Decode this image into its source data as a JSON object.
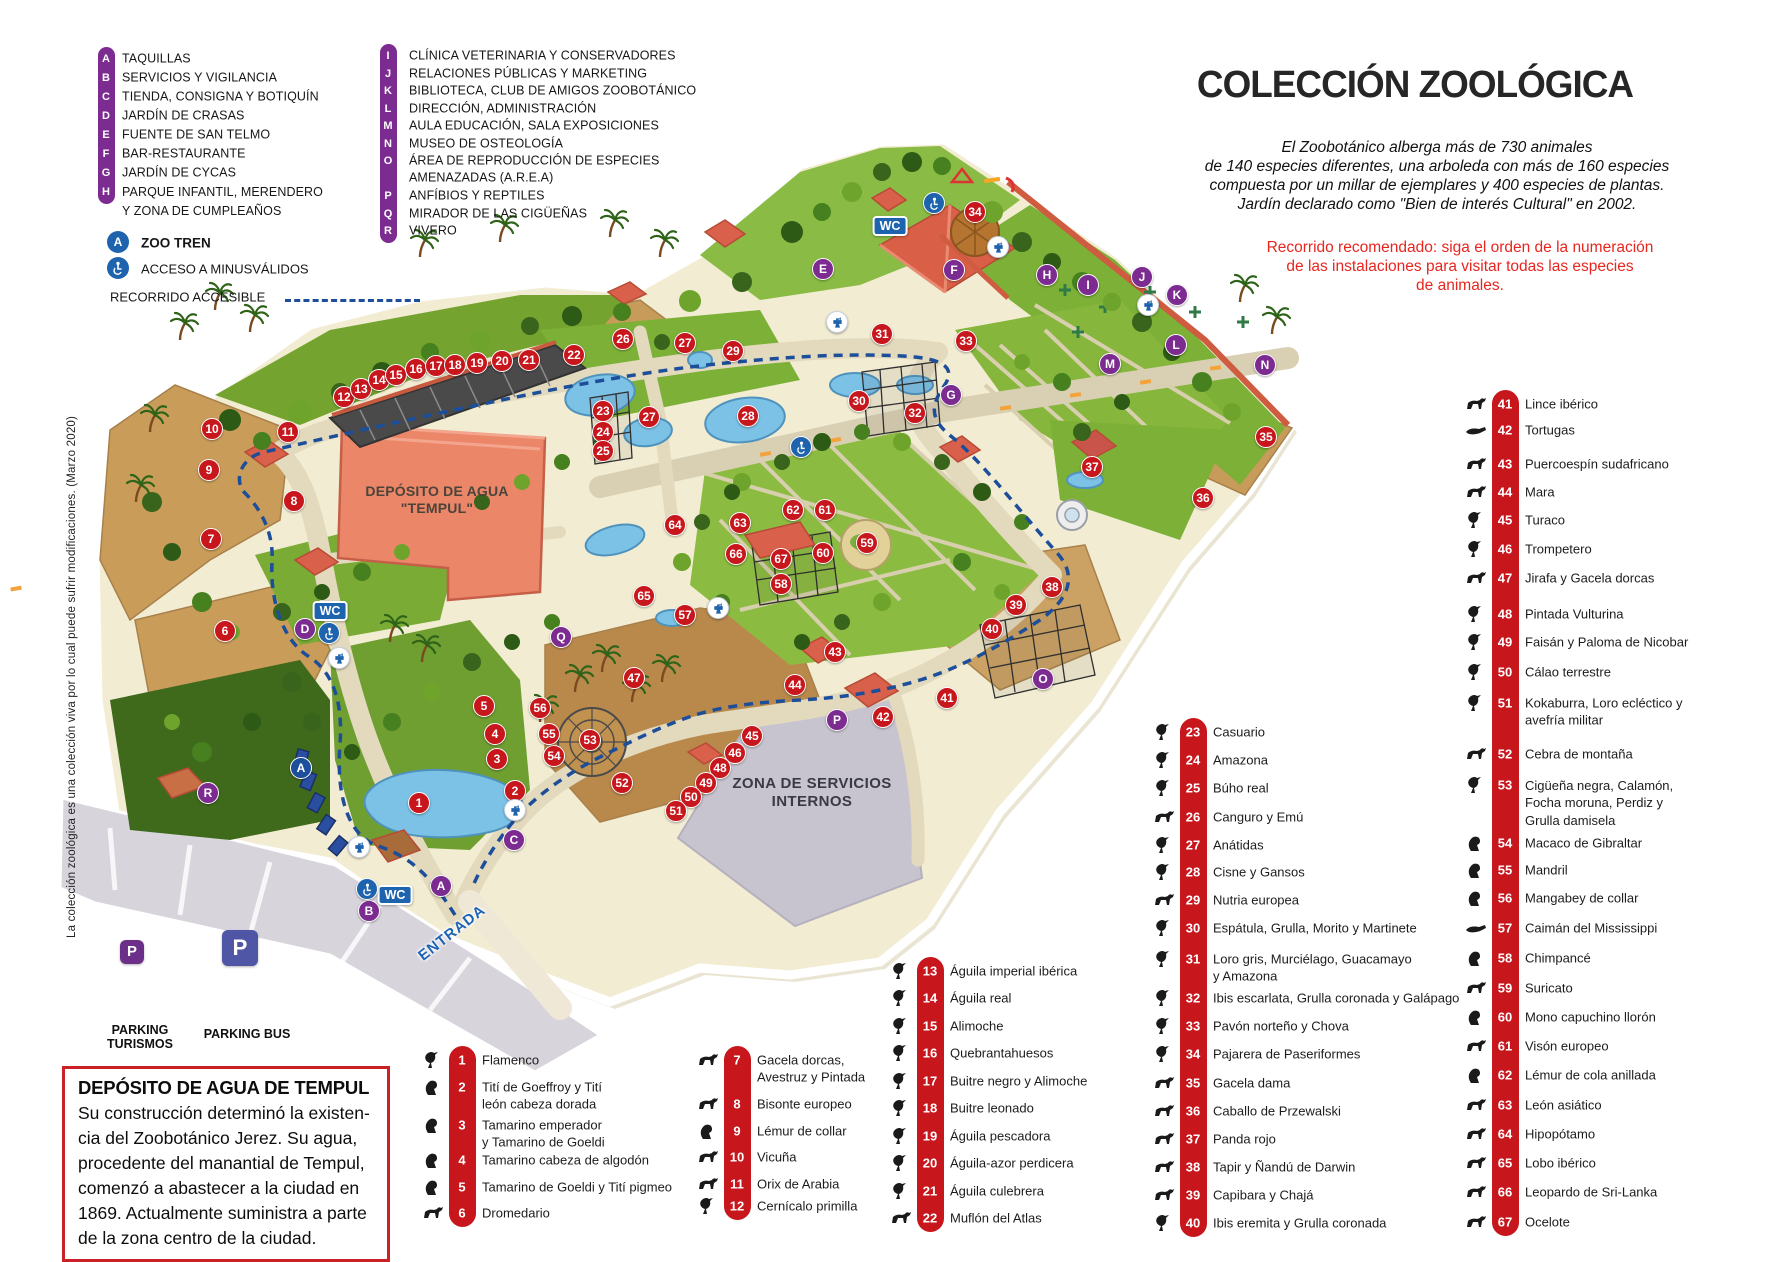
{
  "colors": {
    "red": "#c8161d",
    "purple": "#7c2b90",
    "blue": "#1e63ae",
    "route_blue": "#1d4e9a",
    "note_red": "#e8251f"
  },
  "legend": {
    "col1": [
      {
        "letter": "A",
        "label": "TAQUILLAS"
      },
      {
        "letter": "B",
        "label": "SERVICIOS Y VIGILANCIA"
      },
      {
        "letter": "C",
        "label": "TIENDA, CONSIGNA Y BOTIQUÍN"
      },
      {
        "letter": "D",
        "label": "JARDÍN DE CRASAS"
      },
      {
        "letter": "E",
        "label": "FUENTE DE SAN TELMO"
      },
      {
        "letter": "F",
        "label": "BAR-RESTAURANTE"
      },
      {
        "letter": "G",
        "label": "JARDÍN DE CYCAS"
      },
      {
        "letter": "H",
        "label": "PARQUE INFANTIL, MERENDERO\nY ZONA DE CUMPLEAÑOS"
      }
    ],
    "col2": [
      {
        "letter": "I",
        "label": "CLÍNICA VETERINARIA Y CONSERVADORES"
      },
      {
        "letter": "J",
        "label": "RELACIONES PÚBLICAS Y MARKETING"
      },
      {
        "letter": "K",
        "label": "BIBLIOTECA, CLUB DE AMIGOS ZOOBOTÁNICO"
      },
      {
        "letter": "L",
        "label": "DIRECCIÓN, ADMINISTRACIÓN"
      },
      {
        "letter": "M",
        "label": "AULA EDUCACIÓN, SALA EXPOSICIONES"
      },
      {
        "letter": "N",
        "label": "MUSEO DE OSTEOLOGÍA"
      },
      {
        "letter": "O",
        "label": "ÁREA DE REPRODUCCIÓN DE ESPECIES\nAMENAZADAS (A.R.E.A)"
      },
      {
        "letter": "P",
        "label": "ANFÍBIOS Y REPTILES"
      },
      {
        "letter": "Q",
        "label": "MIRADOR DE LAS CIGÜEÑAS"
      },
      {
        "letter": "R",
        "label": "VIVERO"
      }
    ],
    "zoo_tren_letter": "A",
    "zoo_tren": "ZOO TREN",
    "acceso": "ACCESO A MINUSVÁLIDOS",
    "recorrido": "RECORRIDO ACCESIBLE"
  },
  "header": {
    "title": "COLECCIÓN ZOOLÓGICA",
    "intro_lines": [
      "El Zoobotánico alberga más de 730 animales",
      "de 140 especies diferentes,  una arboleda con más de 160 especies",
      "compuesta por un millar de  ejemplares y 400 especies de plantas.",
      "Jardín declarado como \"Bien de interés Cultural\" en 2002."
    ],
    "route_lines": [
      "Recorrido recomendado: siga el orden de la numeración",
      "de las instalaciones para visitar todas las especies",
      "de animales."
    ]
  },
  "species_columns": [
    {
      "bar_x": 462,
      "items": [
        {
          "n": "1",
          "y": 1060,
          "icon": "bird",
          "label": "Flamenco"
        },
        {
          "n": "2",
          "y": 1087,
          "icon": "primate",
          "label": "Tití de Goeffroy y Tití\nleón cabeza dorada"
        },
        {
          "n": "3",
          "y": 1125,
          "icon": "primate",
          "label": "Tamarino emperador\ny Tamarino de Goeldi"
        },
        {
          "n": "4",
          "y": 1160,
          "icon": "primate",
          "label": "Tamarino cabeza de algodón"
        },
        {
          "n": "5",
          "y": 1187,
          "icon": "primate",
          "label": "Tamarino de Goeldi y Tití pigmeo"
        },
        {
          "n": "6",
          "y": 1213,
          "icon": "mammal",
          "label": "Dromedario"
        }
      ]
    },
    {
      "bar_x": 737,
      "items": [
        {
          "n": "7",
          "y": 1060,
          "icon": "mammal",
          "label": "Gacela dorcas,\nAvestruz y Pintada"
        },
        {
          "n": "8",
          "y": 1104,
          "icon": "mammal",
          "label": "Bisonte europeo"
        },
        {
          "n": "9",
          "y": 1131,
          "icon": "primate",
          "label": "Lémur de collar"
        },
        {
          "n": "10",
          "y": 1157,
          "icon": "mammal",
          "label": "Vicuña"
        },
        {
          "n": "11",
          "y": 1184,
          "icon": "mammal",
          "label": "Orix de Arabia"
        },
        {
          "n": "12",
          "y": 1206,
          "icon": "bird",
          "label": "Cernícalo primilla"
        }
      ]
    },
    {
      "bar_x": 930,
      "items": [
        {
          "n": "13",
          "y": 971,
          "icon": "bird",
          "label": "Águila imperial ibérica"
        },
        {
          "n": "14",
          "y": 998,
          "icon": "bird",
          "label": "Águila real"
        },
        {
          "n": "15",
          "y": 1026,
          "icon": "bird",
          "label": "Alimoche"
        },
        {
          "n": "16",
          "y": 1053,
          "icon": "bird",
          "label": "Quebrantahuesos"
        },
        {
          "n": "17",
          "y": 1081,
          "icon": "bird",
          "label": "Buitre negro y Alimoche"
        },
        {
          "n": "18",
          "y": 1108,
          "icon": "bird",
          "label": "Buitre leonado"
        },
        {
          "n": "19",
          "y": 1136,
          "icon": "bird",
          "label": "Águila pescadora"
        },
        {
          "n": "20",
          "y": 1163,
          "icon": "bird",
          "label": "Águila-azor perdicera"
        },
        {
          "n": "21",
          "y": 1191,
          "icon": "bird",
          "label": "Águila culebrera"
        },
        {
          "n": "22",
          "y": 1218,
          "icon": "mammal",
          "label": "Muflón del Atlas"
        }
      ]
    },
    {
      "bar_x": 1193,
      "items": [
        {
          "n": "23",
          "y": 732,
          "icon": "bird",
          "label": "Casuario"
        },
        {
          "n": "24",
          "y": 760,
          "icon": "bird",
          "label": "Amazona"
        },
        {
          "n": "25",
          "y": 788,
          "icon": "bird",
          "label": "Búho real"
        },
        {
          "n": "26",
          "y": 817,
          "icon": "mammal",
          "label": "Canguro y Emú"
        },
        {
          "n": "27",
          "y": 845,
          "icon": "bird",
          "label": "Anátidas"
        },
        {
          "n": "28",
          "y": 872,
          "icon": "bird",
          "label": "Cisne y Gansos"
        },
        {
          "n": "29",
          "y": 900,
          "icon": "mammal",
          "label": "Nutria europea"
        },
        {
          "n": "30",
          "y": 928,
          "icon": "bird",
          "label": "Espátula, Grulla, Morito y Martinete"
        },
        {
          "n": "31",
          "y": 959,
          "icon": "bird",
          "label": "Loro gris, Murciélago, Guacamayo\ny Amazona"
        },
        {
          "n": "32",
          "y": 998,
          "icon": "bird",
          "label": "Ibis escarlata, Grulla coronada y Galápago"
        },
        {
          "n": "33",
          "y": 1026,
          "icon": "bird",
          "label": "Pavón norteño y Chova"
        },
        {
          "n": "34",
          "y": 1054,
          "icon": "bird",
          "label": "Pajarera de Paseriformes"
        },
        {
          "n": "35",
          "y": 1083,
          "icon": "mammal",
          "label": "Gacela dama"
        },
        {
          "n": "36",
          "y": 1111,
          "icon": "mammal",
          "label": "Caballo de Przewalski"
        },
        {
          "n": "37",
          "y": 1139,
          "icon": "mammal",
          "label": "Panda rojo"
        },
        {
          "n": "38",
          "y": 1167,
          "icon": "mammal",
          "label": "Tapir y Ñandú de Darwin"
        },
        {
          "n": "39",
          "y": 1195,
          "icon": "mammal",
          "label": "Capibara y Chajá"
        },
        {
          "n": "40",
          "y": 1223,
          "icon": "bird",
          "label": "Ibis eremita y Grulla coronada"
        }
      ]
    },
    {
      "bar_x": 1505,
      "items": [
        {
          "n": "41",
          "y": 404,
          "icon": "mammal",
          "label": "Lince ibérico"
        },
        {
          "n": "42",
          "y": 430,
          "icon": "reptile",
          "label": "Tortugas"
        },
        {
          "n": "43",
          "y": 464,
          "icon": "mammal",
          "label": "Puercoespín sudafricano"
        },
        {
          "n": "44",
          "y": 492,
          "icon": "mammal",
          "label": "Mara"
        },
        {
          "n": "45",
          "y": 520,
          "icon": "bird",
          "label": "Turaco"
        },
        {
          "n": "46",
          "y": 549,
          "icon": "bird",
          "label": "Trompetero"
        },
        {
          "n": "47",
          "y": 578,
          "icon": "mammal",
          "label": "Jirafa y Gacela dorcas"
        },
        {
          "n": "48",
          "y": 614,
          "icon": "bird",
          "label": "Pintada Vulturina"
        },
        {
          "n": "49",
          "y": 642,
          "icon": "bird",
          "label": "Faisán y Paloma de Nicobar"
        },
        {
          "n": "50",
          "y": 672,
          "icon": "bird",
          "label": "Cálao terrestre"
        },
        {
          "n": "51",
          "y": 703,
          "icon": "bird",
          "label": "Kokaburra, Loro ecléctico y\navefría militar"
        },
        {
          "n": "52",
          "y": 754,
          "icon": "mammal",
          "label": "Cebra de montaña"
        },
        {
          "n": "53",
          "y": 785,
          "icon": "bird",
          "label": "Cigüeña negra, Calamón,\nFocha moruna, Perdiz y\nGrulla damisela"
        },
        {
          "n": "54",
          "y": 843,
          "icon": "primate",
          "label": "Macaco de Gibraltar"
        },
        {
          "n": "55",
          "y": 870,
          "icon": "primate",
          "label": "Mandril"
        },
        {
          "n": "56",
          "y": 898,
          "icon": "primate",
          "label": "Mangabey de collar"
        },
        {
          "n": "57",
          "y": 928,
          "icon": "reptile",
          "label": "Caimán del Mississippi"
        },
        {
          "n": "58",
          "y": 958,
          "icon": "primate",
          "label": "Chimpancé"
        },
        {
          "n": "59",
          "y": 988,
          "icon": "mammal",
          "label": "Suricato"
        },
        {
          "n": "60",
          "y": 1017,
          "icon": "primate",
          "label": "Mono capuchino llorón"
        },
        {
          "n": "61",
          "y": 1046,
          "icon": "mammal",
          "label": "Visón europeo"
        },
        {
          "n": "62",
          "y": 1075,
          "icon": "primate",
          "label": "Lémur de cola anillada"
        },
        {
          "n": "63",
          "y": 1105,
          "icon": "mammal",
          "label": "León asiático"
        },
        {
          "n": "64",
          "y": 1134,
          "icon": "mammal",
          "label": "Hipopótamo"
        },
        {
          "n": "65",
          "y": 1163,
          "icon": "mammal",
          "label": "Lobo ibérico"
        },
        {
          "n": "66",
          "y": 1192,
          "icon": "mammal",
          "label": "Leopardo de Sri-Lanka"
        },
        {
          "n": "67",
          "y": 1222,
          "icon": "mammal",
          "label": "Ocelote"
        }
      ]
    }
  ],
  "map_labels": {
    "deposito": "DEPÓSITO DE AGUA\n\"TEMPUL\"",
    "zona_servicios": "ZONA DE SERVICIOS\nINTERNOS",
    "entrada": "ENTRADA",
    "parking_turismos": "PARKING\nTURISMOS",
    "parking_bus": "PARKING BUS",
    "wc": "WC",
    "parking_p": "P"
  },
  "map_markers": {
    "numbers": [
      {
        "n": "1",
        "x": 419,
        "y": 803
      },
      {
        "n": "2",
        "x": 515,
        "y": 791
      },
      {
        "n": "3",
        "x": 497,
        "y": 759
      },
      {
        "n": "4",
        "x": 495,
        "y": 734
      },
      {
        "n": "5",
        "x": 484,
        "y": 706
      },
      {
        "n": "6",
        "x": 225,
        "y": 631
      },
      {
        "n": "7",
        "x": 211,
        "y": 539
      },
      {
        "n": "8",
        "x": 294,
        "y": 501
      },
      {
        "n": "9",
        "x": 209,
        "y": 470
      },
      {
        "n": "10",
        "x": 212,
        "y": 429
      },
      {
        "n": "11",
        "x": 288,
        "y": 432
      },
      {
        "n": "12",
        "x": 344,
        "y": 397
      },
      {
        "n": "13",
        "x": 361,
        "y": 389
      },
      {
        "n": "14",
        "x": 379,
        "y": 380
      },
      {
        "n": "15",
        "x": 396,
        "y": 375
      },
      {
        "n": "16",
        "x": 416,
        "y": 369
      },
      {
        "n": "17",
        "x": 436,
        "y": 366
      },
      {
        "n": "18",
        "x": 455,
        "y": 365
      },
      {
        "n": "19",
        "x": 477,
        "y": 363
      },
      {
        "n": "20",
        "x": 502,
        "y": 361
      },
      {
        "n": "21",
        "x": 529,
        "y": 360
      },
      {
        "n": "22",
        "x": 574,
        "y": 355
      },
      {
        "n": "23",
        "x": 603,
        "y": 411
      },
      {
        "n": "24",
        "x": 603,
        "y": 432
      },
      {
        "n": "25",
        "x": 603,
        "y": 451
      },
      {
        "n": "26",
        "x": 623,
        "y": 339
      },
      {
        "n": "27",
        "x": 685,
        "y": 343
      },
      {
        "n": "27",
        "x": 649,
        "y": 417
      },
      {
        "n": "28",
        "x": 748,
        "y": 416
      },
      {
        "n": "29",
        "x": 733,
        "y": 351
      },
      {
        "n": "30",
        "x": 859,
        "y": 401
      },
      {
        "n": "31",
        "x": 882,
        "y": 334
      },
      {
        "n": "32",
        "x": 915,
        "y": 413
      },
      {
        "n": "33",
        "x": 966,
        "y": 341
      },
      {
        "n": "34",
        "x": 975,
        "y": 212
      },
      {
        "n": "35",
        "x": 1266,
        "y": 437
      },
      {
        "n": "36",
        "x": 1203,
        "y": 498
      },
      {
        "n": "37",
        "x": 1092,
        "y": 467
      },
      {
        "n": "38",
        "x": 1052,
        "y": 587
      },
      {
        "n": "39",
        "x": 1016,
        "y": 605
      },
      {
        "n": "40",
        "x": 992,
        "y": 629
      },
      {
        "n": "41",
        "x": 947,
        "y": 698
      },
      {
        "n": "42",
        "x": 883,
        "y": 717
      },
      {
        "n": "43",
        "x": 835,
        "y": 652
      },
      {
        "n": "44",
        "x": 795,
        "y": 685
      },
      {
        "n": "45",
        "x": 752,
        "y": 736
      },
      {
        "n": "46",
        "x": 735,
        "y": 753
      },
      {
        "n": "47",
        "x": 634,
        "y": 678
      },
      {
        "n": "48",
        "x": 720,
        "y": 768
      },
      {
        "n": "49",
        "x": 706,
        "y": 783
      },
      {
        "n": "50",
        "x": 691,
        "y": 797
      },
      {
        "n": "51",
        "x": 676,
        "y": 811
      },
      {
        "n": "52",
        "x": 622,
        "y": 783
      },
      {
        "n": "53",
        "x": 590,
        "y": 740
      },
      {
        "n": "54",
        "x": 554,
        "y": 756
      },
      {
        "n": "55",
        "x": 549,
        "y": 734
      },
      {
        "n": "56",
        "x": 540,
        "y": 708
      },
      {
        "n": "57",
        "x": 685,
        "y": 615
      },
      {
        "n": "58",
        "x": 781,
        "y": 584
      },
      {
        "n": "59",
        "x": 867,
        "y": 543
      },
      {
        "n": "60",
        "x": 823,
        "y": 553
      },
      {
        "n": "61",
        "x": 825,
        "y": 510
      },
      {
        "n": "62",
        "x": 793,
        "y": 510
      },
      {
        "n": "63",
        "x": 740,
        "y": 523
      },
      {
        "n": "64",
        "x": 675,
        "y": 525
      },
      {
        "n": "65",
        "x": 644,
        "y": 596
      },
      {
        "n": "66",
        "x": 736,
        "y": 554
      },
      {
        "n": "67",
        "x": 781,
        "y": 559
      }
    ],
    "letters": [
      {
        "l": "A",
        "x": 441,
        "y": 886
      },
      {
        "l": "B",
        "x": 369,
        "y": 911
      },
      {
        "l": "C",
        "x": 514,
        "y": 840
      },
      {
        "l": "D",
        "x": 305,
        "y": 629
      },
      {
        "l": "E",
        "x": 823,
        "y": 269
      },
      {
        "l": "F",
        "x": 954,
        "y": 270
      },
      {
        "l": "G",
        "x": 951,
        "y": 395
      },
      {
        "l": "H",
        "x": 1047,
        "y": 275
      },
      {
        "l": "I",
        "x": 1088,
        "y": 285
      },
      {
        "l": "J",
        "x": 1142,
        "y": 277
      },
      {
        "l": "K",
        "x": 1177,
        "y": 295
      },
      {
        "l": "L",
        "x": 1176,
        "y": 345
      },
      {
        "l": "M",
        "x": 1110,
        "y": 364
      },
      {
        "l": "N",
        "x": 1265,
        "y": 365
      },
      {
        "l": "O",
        "x": 1043,
        "y": 679
      },
      {
        "l": "P",
        "x": 837,
        "y": 720
      },
      {
        "l": "Q",
        "x": 561,
        "y": 637
      },
      {
        "l": "R",
        "x": 208,
        "y": 793
      }
    ],
    "tren_stop": {
      "l": "A",
      "x": 301,
      "y": 768
    },
    "wc": [
      {
        "x": 890,
        "y": 226
      },
      {
        "x": 330,
        "y": 611
      },
      {
        "x": 395,
        "y": 895
      }
    ],
    "wheelchair": [
      {
        "x": 934,
        "y": 203
      },
      {
        "x": 801,
        "y": 447
      },
      {
        "x": 329,
        "y": 633
      },
      {
        "x": 367,
        "y": 889
      }
    ],
    "faucet": [
      {
        "x": 998,
        "y": 247
      },
      {
        "x": 837,
        "y": 322
      },
      {
        "x": 1148,
        "y": 305
      },
      {
        "x": 339,
        "y": 658
      },
      {
        "x": 515,
        "y": 810
      },
      {
        "x": 718,
        "y": 608
      },
      {
        "x": 359,
        "y": 847
      }
    ],
    "parking": [
      {
        "x": 240,
        "y": 948,
        "size": 36,
        "color": "#4f56a5"
      },
      {
        "x": 132,
        "y": 952,
        "size": 24,
        "color": "#6b2f8a"
      }
    ]
  },
  "info_box": {
    "title": "DEPÓSITO DE AGUA DE TEMPUL",
    "body": "Su construcción determinó la existen-\ncia del Zoobotánico Jerez. Su agua,\nprocedente del manantial de Tempul,\ncomenzó a abastecer a la ciudad en\n1869. Actualmente suministra a parte\nde la zona centro de la ciudad."
  },
  "side_note": "La colección zoológica  es una colección viva por lo cual puede sufrir modificaciones. (Marzo 2020)"
}
